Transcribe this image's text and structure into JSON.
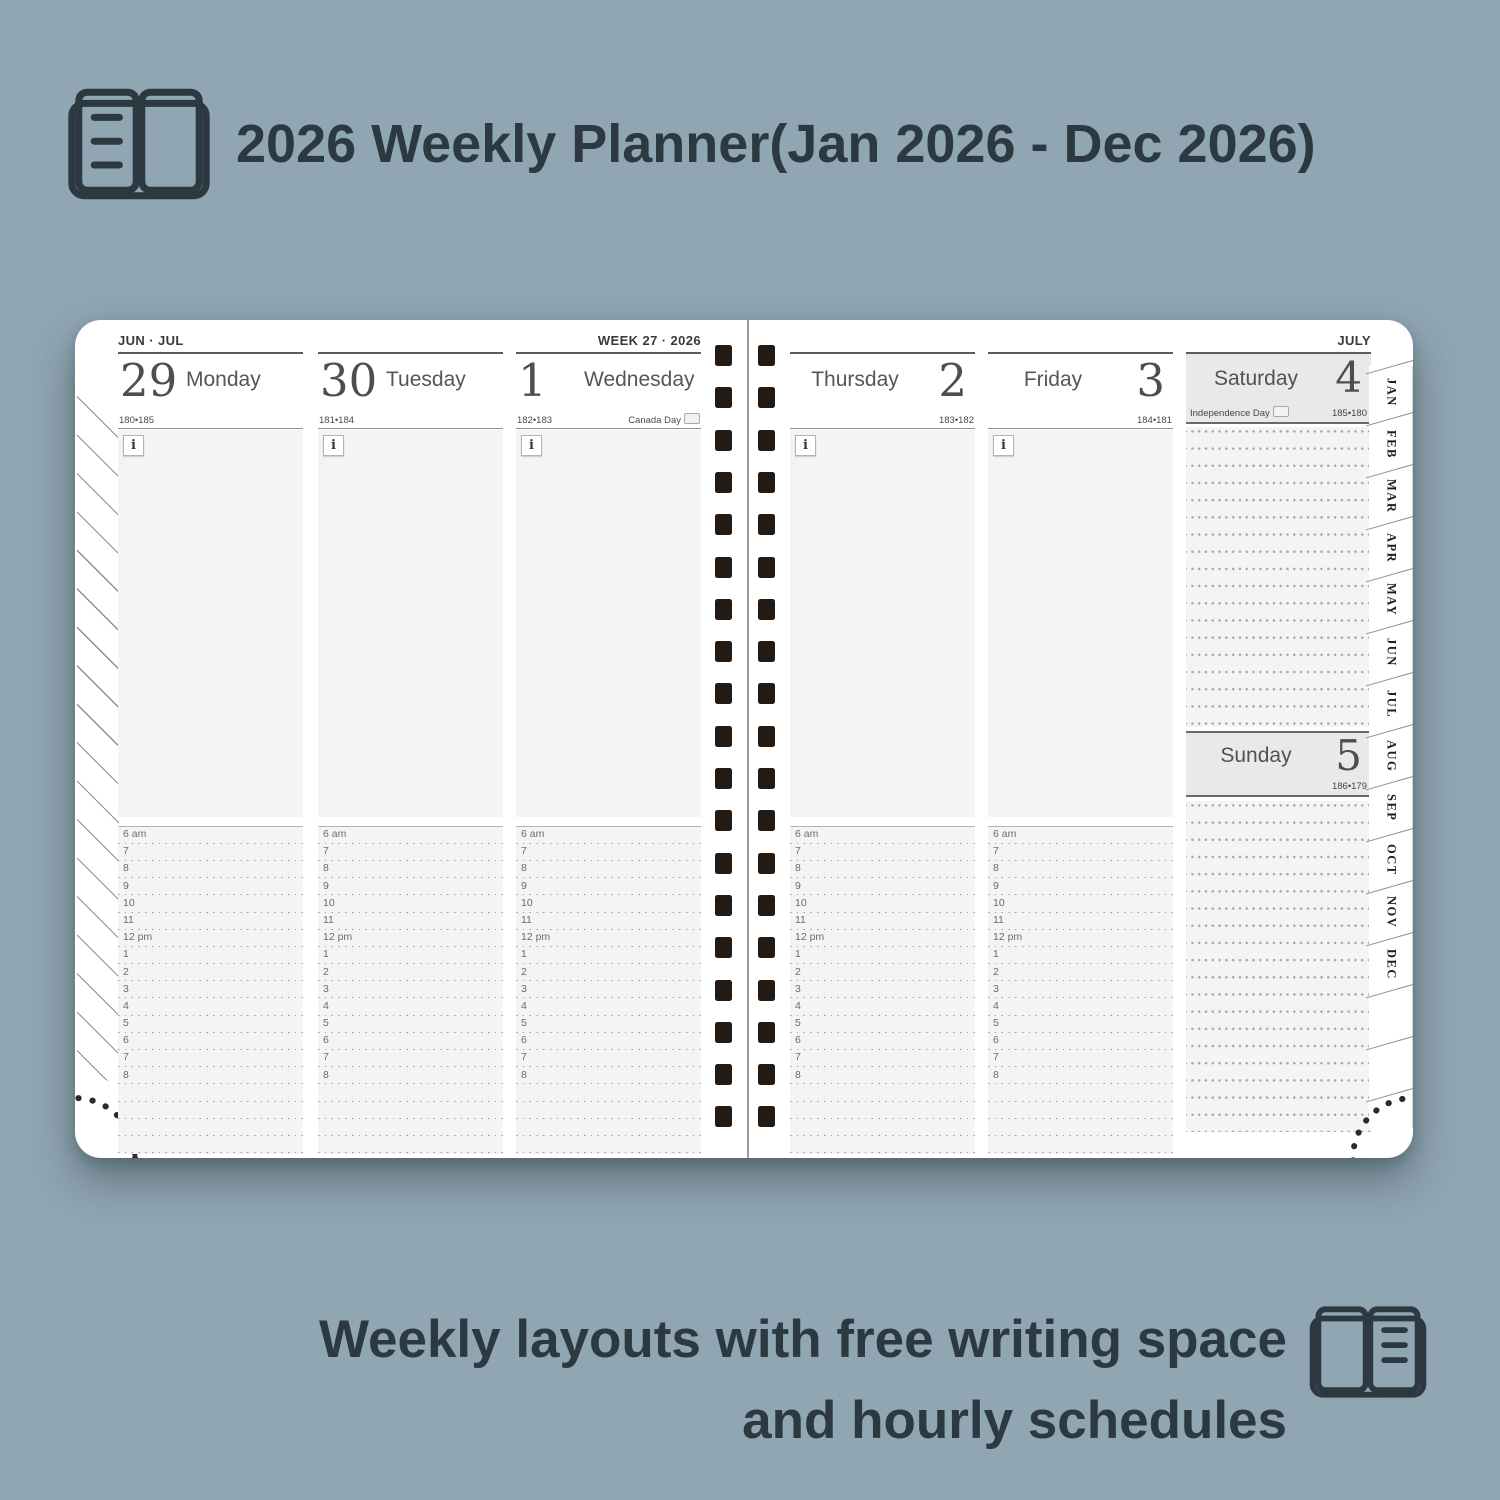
{
  "colors": {
    "background": "#90a6b2",
    "ink": "#2c3940",
    "paper": "#ffffff",
    "panel_gray": "#f4f4f3",
    "weekend_gray": "#e9e9e8",
    "spiral_dark": "#241a14"
  },
  "header": {
    "title": "2026 Weekly Planner(Jan 2026 - Dec 2026)"
  },
  "footer": {
    "line1": "Weekly layouts with free writing space",
    "line2": "and hourly schedules"
  },
  "planner": {
    "left_page": {
      "corner_label": "JUN · JUL",
      "week_label": "WEEK 27 · 2026"
    },
    "right_page": {
      "corner_label": "JULY"
    },
    "info_icon": "i",
    "days": [
      {
        "name": "Monday",
        "number": "29",
        "day_of_year": "180•185",
        "holiday": "",
        "side": "left"
      },
      {
        "name": "Tuesday",
        "number": "30",
        "day_of_year": "181•184",
        "holiday": "",
        "side": "left"
      },
      {
        "name": "Wednesday",
        "number": "1",
        "day_of_year": "182•183",
        "holiday": "Canada Day",
        "holiday_flag": "CA",
        "side": "left"
      },
      {
        "name": "Thursday",
        "number": "2",
        "day_of_year": "183•182",
        "holiday": "",
        "side": "right"
      },
      {
        "name": "Friday",
        "number": "3",
        "day_of_year": "184•181",
        "holiday": "",
        "side": "right"
      },
      {
        "name": "Saturday",
        "number": "4",
        "day_of_year": "185•180",
        "holiday": "Independence Day",
        "holiday_flag": "US",
        "side": "weekend"
      },
      {
        "name": "Sunday",
        "number": "5",
        "day_of_year": "186•179",
        "holiday": "",
        "side": "weekend"
      }
    ],
    "schedule_hours": [
      "6 am",
      "7",
      "8",
      "9",
      "10",
      "11",
      "12 pm",
      "1",
      "2",
      "3",
      "4",
      "5",
      "6",
      "7",
      "8"
    ],
    "month_tabs": [
      "JAN",
      "FEB",
      "MAR",
      "APR",
      "MAY",
      "JUN",
      "JUL",
      "AUG",
      "SEP",
      "OCT",
      "NOV",
      "DEC"
    ]
  }
}
